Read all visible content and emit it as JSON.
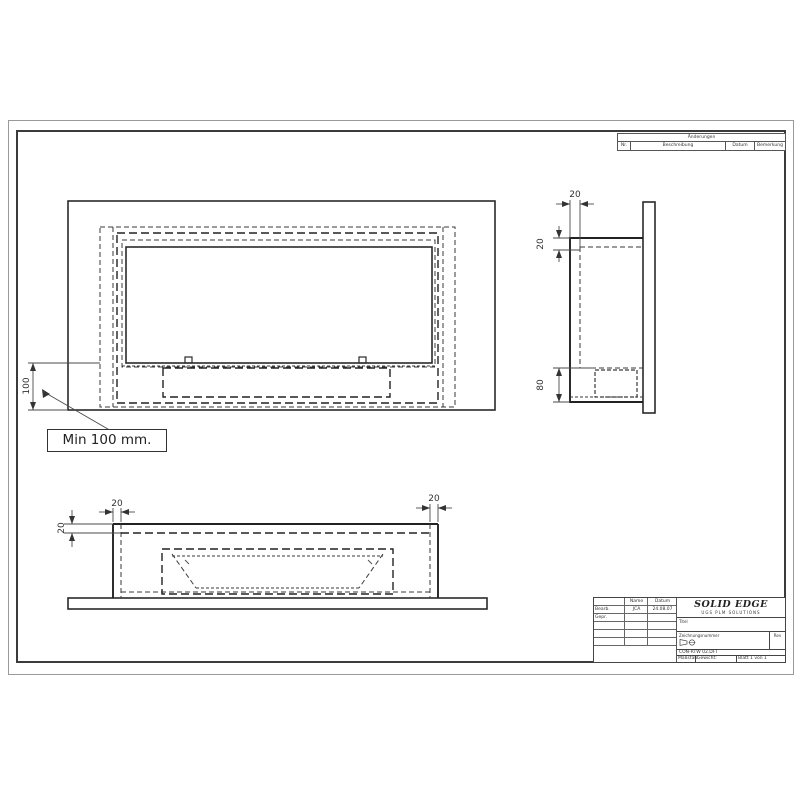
{
  "revision_table": {
    "title": "Änderungen",
    "col_nr": "Nr.",
    "col_description": "Beschreibung",
    "col_date": "Datum",
    "col_remark": "Bemerkung"
  },
  "dimensions": {
    "front_min_height": "100",
    "front_note": "Min 100 mm.",
    "side_wall_width": "20",
    "side_top_offset": "20",
    "side_burner_height": "80",
    "bottom_left_wall": "20",
    "bottom_right_wall": "20",
    "bottom_top_offset": "20"
  },
  "title_block": {
    "logo": "SOLID EDGE",
    "logo_subtitle": "UGS PLM SOLUTIONS",
    "col_name": "Name",
    "col_date": "Datum",
    "row_drawn_label": "Bearb.",
    "row_drawn_name": "JCA",
    "row_drawn_date": "24.08.07",
    "row_checked_label": "Gepr.",
    "title_label": "Titel",
    "drawing_number_label": "Zeichnungsnummer",
    "rev_label": "Rev",
    "file_name": "CON-RTW 02.DFT",
    "scale_label": "Maßstab:",
    "weight_label": "Gewicht:",
    "sheet_label": "Blatt 1 von 1"
  }
}
